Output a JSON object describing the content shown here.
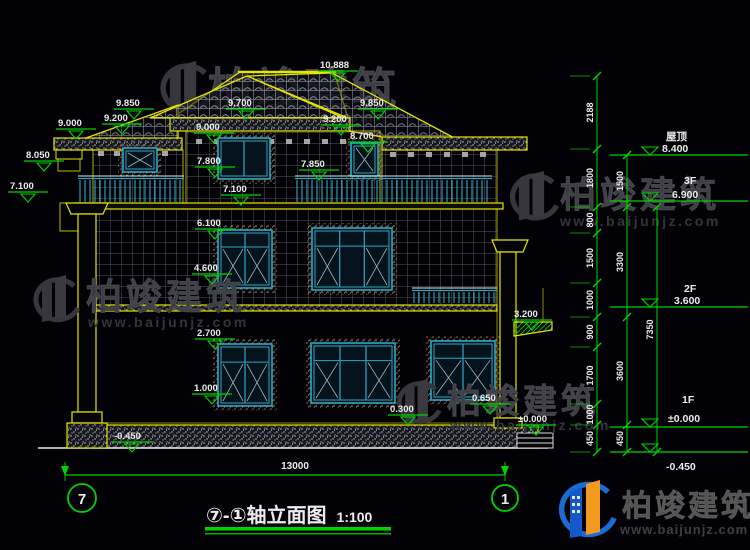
{
  "drawing": {
    "title_prefix": "⑦-①",
    "title": "轴立面图",
    "scale": "1:100",
    "axis_start": "7",
    "axis_end": "1",
    "bottom_dimension": "13000"
  },
  "elevation_markers": [
    "10.888",
    "9.850",
    "9.200",
    "9.000",
    "9.700",
    "9.000",
    "9.850",
    "9.200",
    "8.700",
    "8.050",
    "7.800",
    "7.850",
    "7.100",
    "7.100",
    "6.100",
    "4.600",
    "3.200",
    "2.700",
    "1.000",
    "0.650",
    "0.300",
    "±0.000",
    "-0.450"
  ],
  "floor_markers": [
    {
      "label": "屋顶",
      "value": "8.400"
    },
    {
      "label": "3F",
      "value": "6.900"
    },
    {
      "label": "2F",
      "value": "3.600"
    },
    {
      "label": "1F",
      "value": "±0.000"
    },
    {
      "label": "",
      "value": "-0.450"
    }
  ],
  "dim_chain_outer": [
    "2188",
    "1800",
    "800",
    "1500",
    "1000",
    "900",
    "1700",
    "1000",
    "450"
  ],
  "dim_chain_inner": [
    "1500",
    "3300",
    "3600",
    "450"
  ],
  "dim_overall_height": "7350",
  "watermark": {
    "brand": "柏竣建筑",
    "url": "www.baijunjz.com"
  },
  "logo": {
    "brand": "柏竣建筑",
    "url": "www.baijunjz.com"
  },
  "colors": {
    "background": "#020206",
    "line_yellow": "#e6e600",
    "annotation_green": "#00d400",
    "window_cyan": "#2fa8c4",
    "text_white": "#ececec"
  }
}
